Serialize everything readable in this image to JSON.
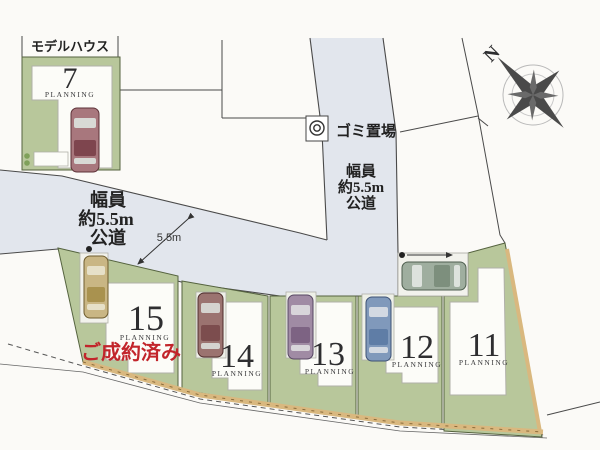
{
  "map": {
    "model_house_label": "モデルハウス",
    "garbage_station_label": "ゴミ置場",
    "north_label": "N",
    "road_width_dimension": "5.5m",
    "road_label_vertical": [
      "幅員",
      "約5.5m",
      "公道"
    ],
    "road_label_horizontal": [
      "幅員",
      "約5.5m",
      "公道"
    ],
    "sold_label": "ご成約済み",
    "lots": [
      {
        "number": "7",
        "sub": "PLANNING"
      },
      {
        "number": "15",
        "sub": "PLANNING"
      },
      {
        "number": "14",
        "sub": "PLANNING"
      },
      {
        "number": "13",
        "sub": "PLANNING"
      },
      {
        "number": "12",
        "sub": "PLANNING"
      },
      {
        "number": "11",
        "sub": "PLANNING"
      }
    ],
    "colors": {
      "road": "#e2e6ed",
      "lot_green": "#b8c79b",
      "wall_tan": "#d9b87f",
      "sold_red": "#c2252b"
    }
  }
}
